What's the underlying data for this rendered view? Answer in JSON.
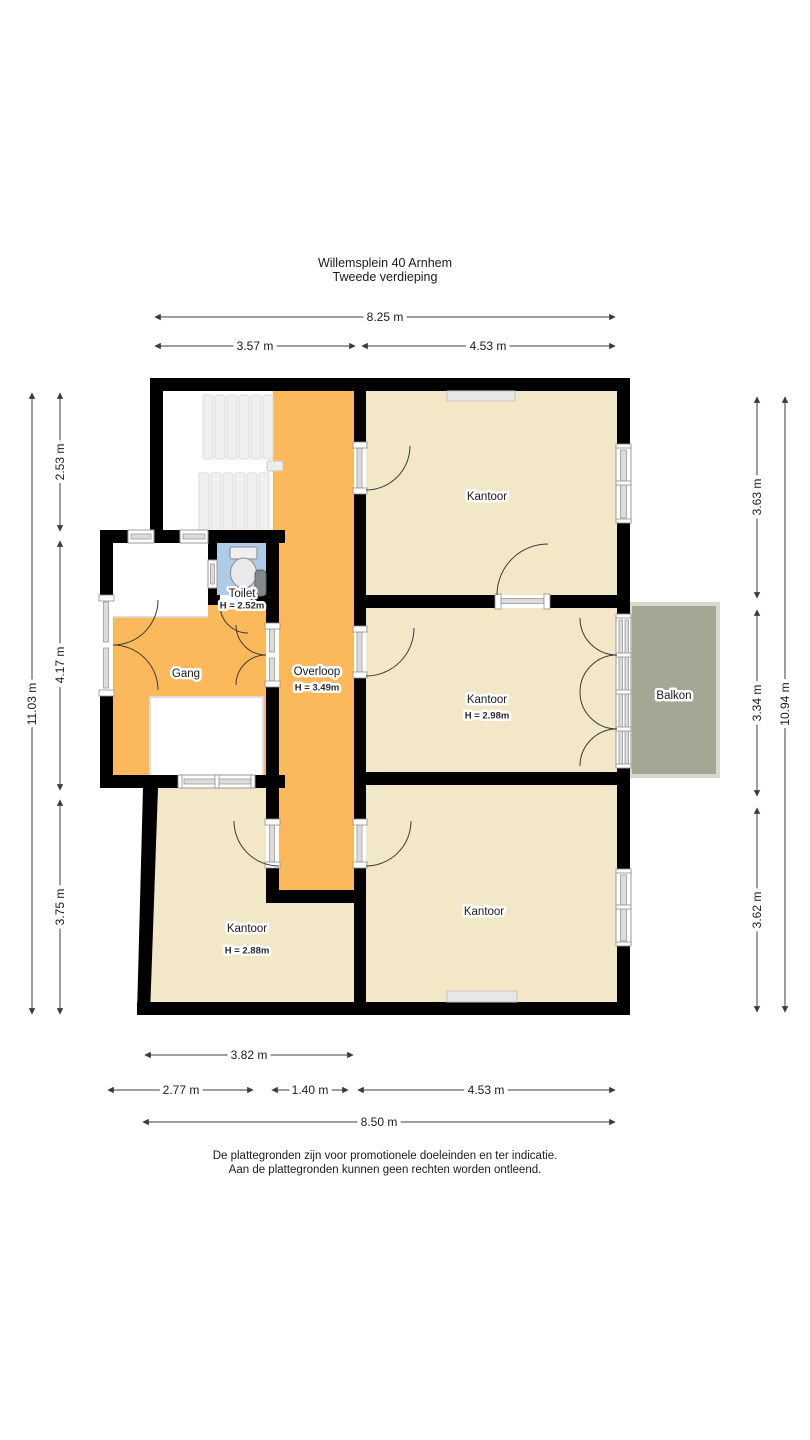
{
  "title": {
    "line1": "Willemsplein 40 Arnhem",
    "line2": "Tweede verdieping"
  },
  "dims": {
    "top_full": "8.25 m",
    "top_left": "3.57 m",
    "top_right": "4.53 m",
    "left_full": "11.03 m",
    "left_top": "2.53 m",
    "left_mid": "4.17 m",
    "left_bottom": "3.75 m",
    "right_top": "3.63 m",
    "right_mid": "3.34 m",
    "right_bottom": "3.62 m",
    "right_full": "10.94 m",
    "bottom_inner": "3.82 m",
    "bottom_left": "2.77 m",
    "bottom_mid": "1.40 m",
    "bottom_right": "4.53 m",
    "bottom_full": "8.50 m"
  },
  "rooms": {
    "kantoor_top": {
      "label": "Kantoor"
    },
    "kantoor_mid": {
      "label": "Kantoor",
      "height": "H = 2.98m"
    },
    "kantoor_bottom_right": {
      "label": "Kantoor"
    },
    "kantoor_bottom_left": {
      "label": "Kantoor",
      "height": "H = 2.88m"
    },
    "gang": {
      "label": "Gang"
    },
    "overloop": {
      "label": "Overloop",
      "height": "H = 3.49m"
    },
    "toilet": {
      "label": "Toilet",
      "height": "H = 2.52m"
    },
    "balkon": {
      "label": "Balkon"
    }
  },
  "footer": {
    "line1": "De plattegronden zijn voor promotionele doeleinden en ter indicatie.",
    "line2": "Aan de plattegronden kunnen geen rechten worden ontleend."
  },
  "colors": {
    "room": "#F2E8C8",
    "circulation": "#FBB95C",
    "toilet": "#AECBE8",
    "balcony": "#A4A794",
    "wall": "#000000",
    "dim": "#3C3C3C"
  }
}
